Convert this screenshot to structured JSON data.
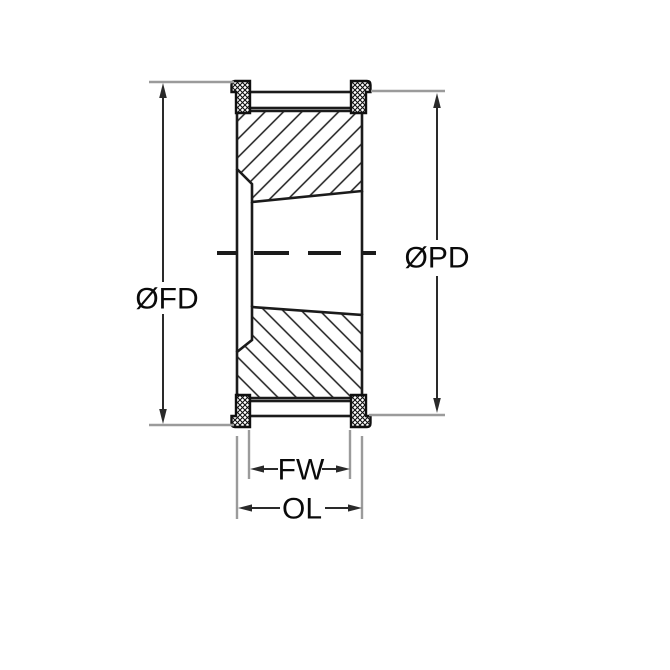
{
  "drawing": {
    "type": "timing-pulley-cross-section",
    "labels": {
      "flange_diameter": "ØFD",
      "pitch_diameter": "ØPD",
      "face_width": "FW",
      "overall_length": "OL"
    },
    "colors": {
      "outline": "#1b1b1b",
      "dimension_line": "#2a2a2a",
      "extension_line": "#9b9b9b",
      "text": "#0a0a0a",
      "background": "#ffffff"
    }
  }
}
